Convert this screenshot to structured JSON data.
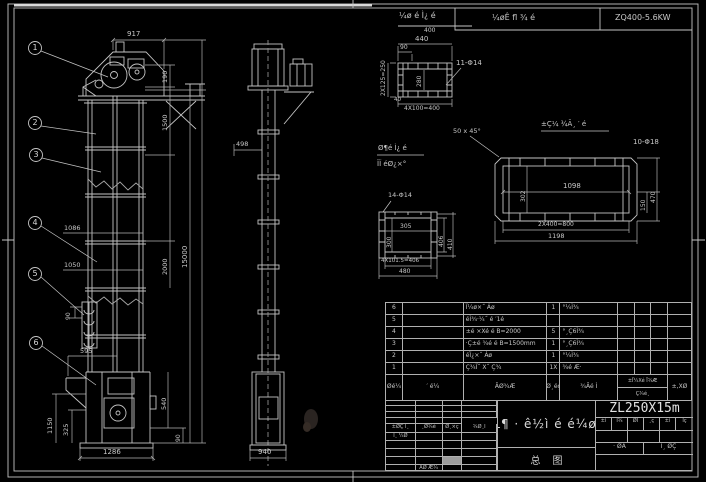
{
  "colors": {
    "background": "#000000",
    "line": "#c4c4c4",
    "text": "#c8c8c8"
  },
  "top": {
    "detail_title": "¼ø é Ì¿ é",
    "detail_scale": "400",
    "cell_mid": "¼øÊ fl ¾ é",
    "cell_right": "ZQ400-5.6KW"
  },
  "front": {
    "balloons": [
      "1",
      "2",
      "3",
      "4",
      "5",
      "6"
    ],
    "dims": {
      "d917": "917",
      "d190": "190",
      "d1500": "1500",
      "d2000": "2000",
      "d15000": "15000",
      "d1086": "1086",
      "d1050": "1050",
      "d90_bucket": "90",
      "d595": "595",
      "d1150": "1150",
      "d325": "325",
      "d1286": "1286",
      "d540": "540",
      "d90_right": "90"
    }
  },
  "side": {
    "dims": {
      "d498": "498",
      "d940": "940"
    }
  },
  "flange": {
    "holes": "11-Φ14",
    "dims": {
      "d440": "440",
      "d90": "90",
      "d40": "40",
      "left": "2X125=250",
      "inner": "280",
      "bottom": "4X100=400"
    }
  },
  "long": {
    "title": "±Ç¼ ¾Ã¸ ′ é",
    "chamfer": "50 x 45°",
    "holes": "10-Φ18",
    "dims": {
      "w": "1098",
      "h": "302",
      "r1": "150",
      "r2": "470",
      "b1": "2X400=800",
      "b2": "1198"
    }
  },
  "square": {
    "t1": "Ø¶é Ì¿ é",
    "t2": "ÏÏ éØ¿×°",
    "holes": "14-Φ14",
    "dims": {
      "w": "305",
      "h": "300",
      "r1": "406",
      "r2": "410",
      "b1": "4X101.5=406",
      "b2": "480"
    }
  },
  "bom": {
    "header": {
      "no": "Øé¼",
      "code": "′ é¼",
      "name": "ÃØ¾Æ",
      "qty": "Ø¸éç",
      "mat": "¾Ãé Ì",
      "wt": "±Ï¼Xé Ï¾Æ",
      "wb": "Ç¾é¸",
      "rem": "±,XØ"
    },
    "rows": [
      {
        "no": "6",
        "code": "",
        "desc": "Ï¼ø×˝ Áø",
        "qty": "1",
        "mat": "°¼Ì¾",
        "w1": "",
        "w2": "",
        "w3": "",
        "rem": ""
      },
      {
        "no": "5",
        "code": "",
        "desc": "éÌ¾·¼˝ é ′1é",
        "qty": "",
        "mat": "",
        "w1": "",
        "w2": "",
        "w3": "",
        "rem": ""
      },
      {
        "no": "4",
        "code": "",
        "desc": "±é ×Xé é B=2000",
        "qty": "5",
        "mat": "°¸Ç6Ì¾",
        "w1": "",
        "w2": "",
        "w3": "",
        "rem": ""
      },
      {
        "no": "3",
        "code": "",
        "desc": "·Ç±é ¾é é B=1500mm",
        "qty": "1",
        "mat": "°¸Ç6Ì¾",
        "w1": "",
        "w2": "",
        "w3": "",
        "rem": ""
      },
      {
        "no": "2",
        "code": "",
        "desc": "éÏ¿×˝ Áø",
        "qty": "1",
        "mat": "°¼Ì¾",
        "w1": "",
        "w2": "",
        "w3": "",
        "rem": ""
      },
      {
        "no": "1",
        "code": "",
        "desc": "Ç¾Ï˝ X˝ Ç¾",
        "qty": "1X",
        "mat": "¾é Æ·",
        "w1": "",
        "w2": "",
        "w3": "",
        "rem": ""
      }
    ]
  },
  "tb": {
    "left": {
      "cells": [
        "±ØÇ Ï¸",
        "¸Ø¾é",
        "Ø¸×ç",
        "¾Ø¸Ï"
      ],
      "row2": "Ï¸ ¼Ø",
      "bottom": "ÁØ Æ¾"
    },
    "main": "ZL¶ · ê½ì é é¼ø ¿",
    "sub": "总图",
    "model": "ZL250X15m",
    "right": {
      "cells": [
        "±ì",
        "Ì¾",
        "ØÏ",
        "¸ç",
        "±ì",
        "Ïç"
      ],
      "row2": [
        "· ØÁ",
        "Ì¸ ØÇ"
      ]
    }
  }
}
